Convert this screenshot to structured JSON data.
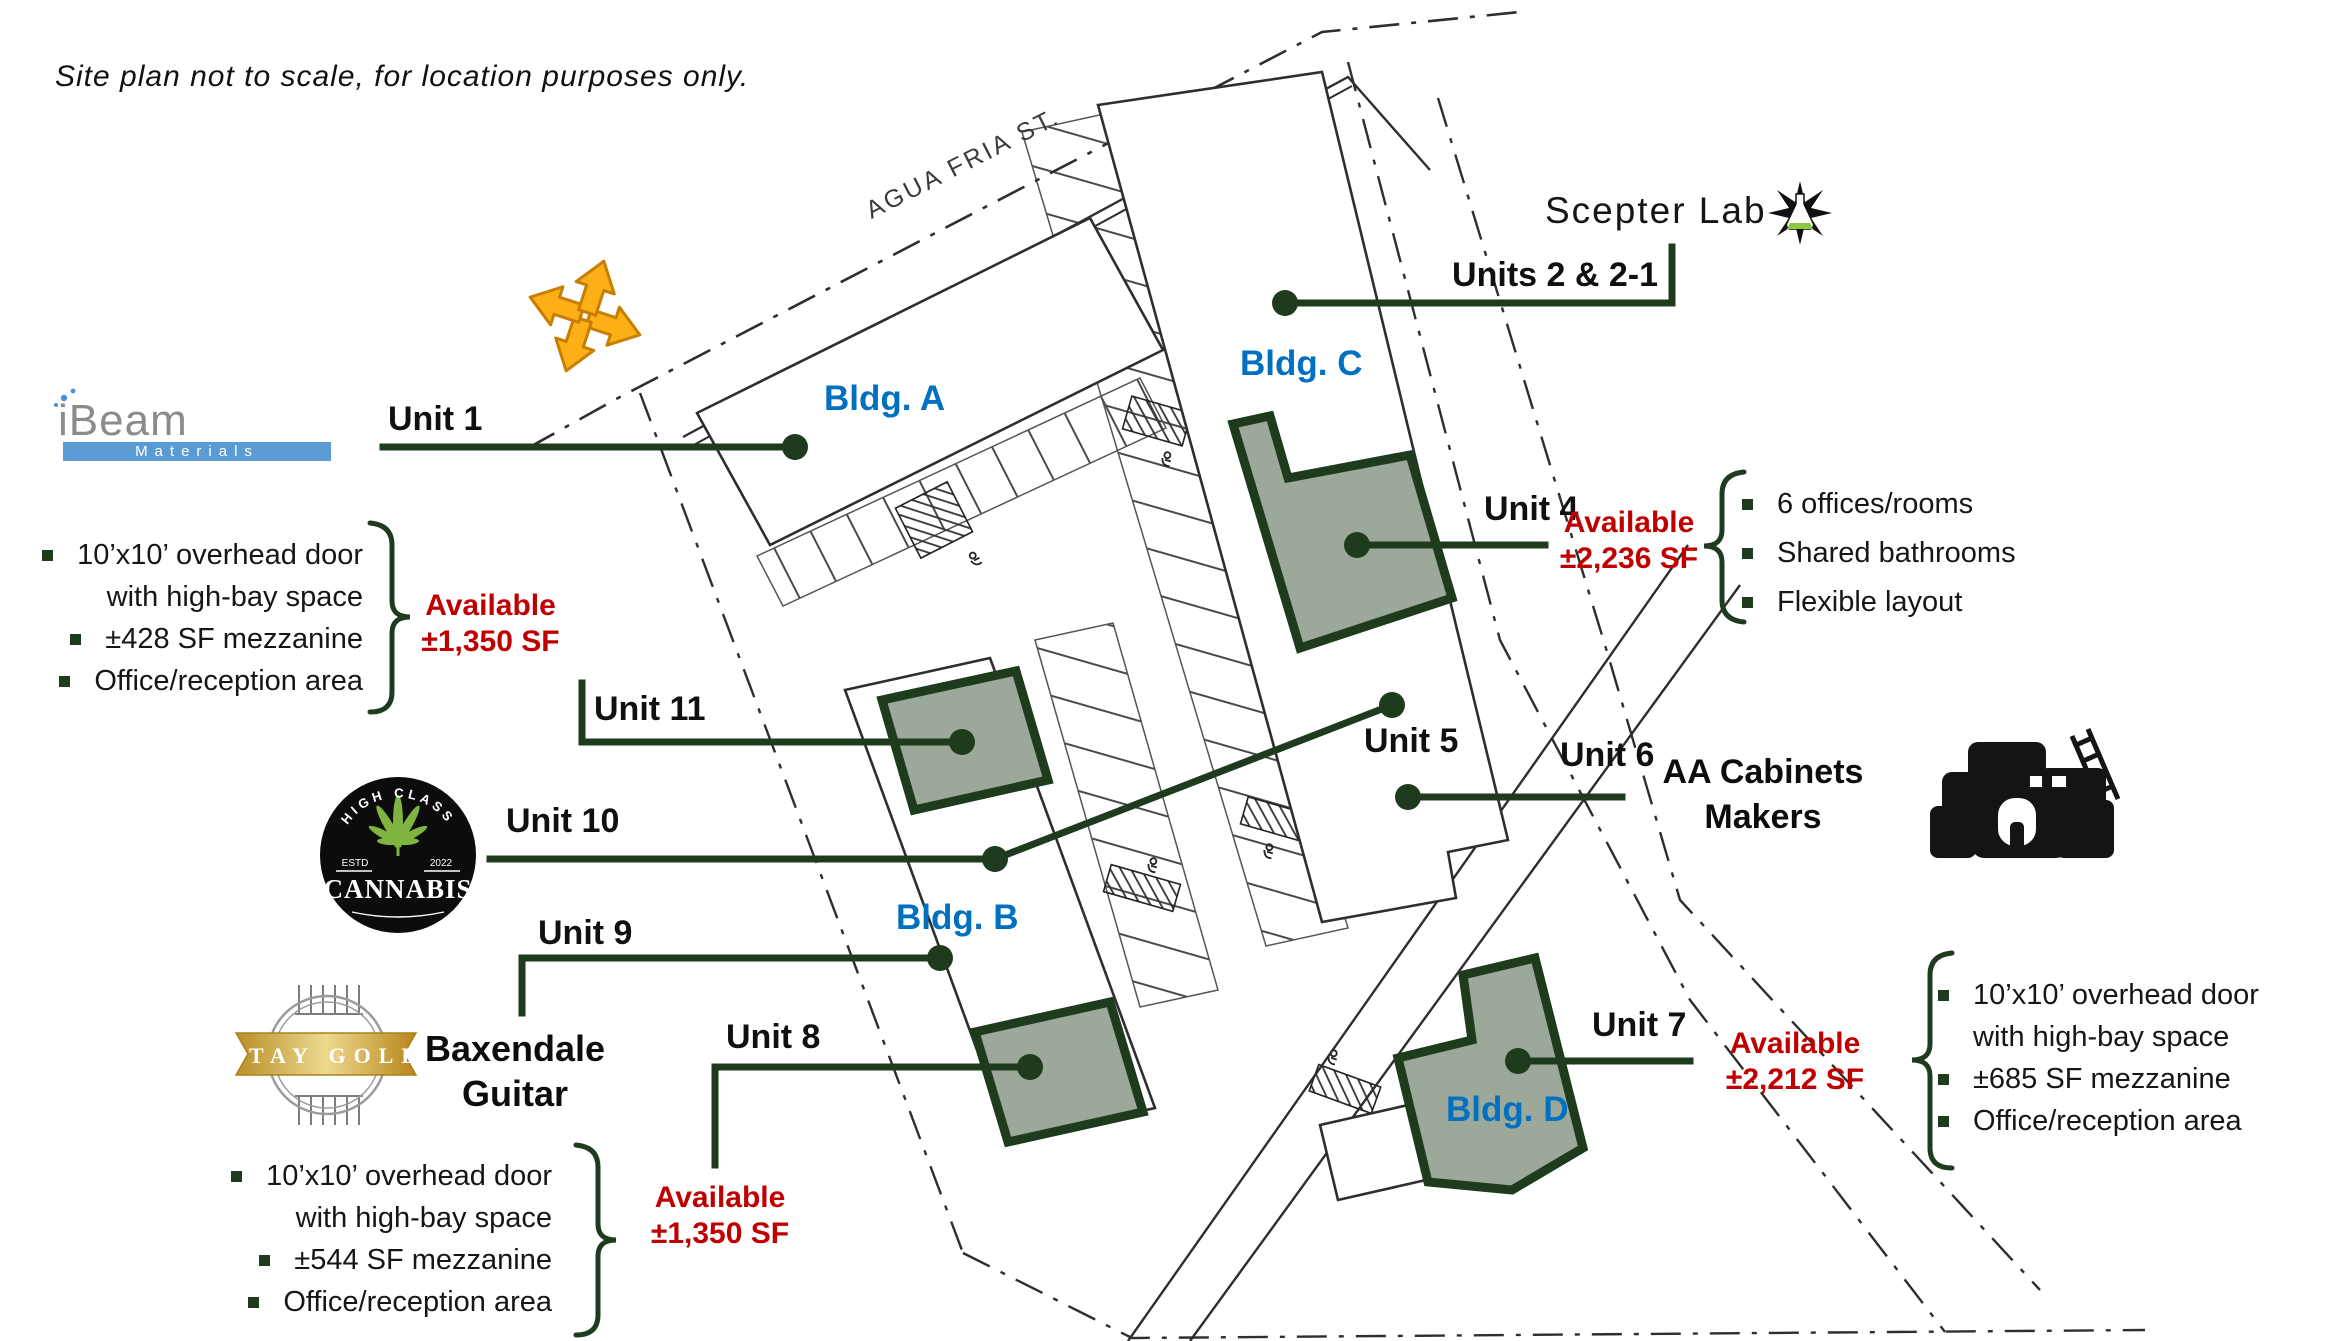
{
  "disclaimer": "Site plan not to scale, for location purposes only.",
  "street_label": "AGUA FRIA ST.",
  "building_labels": {
    "a": "Bldg. A",
    "b": "Bldg. B",
    "c": "Bldg. C",
    "d": "Bldg. D"
  },
  "unit_labels": {
    "u1": "Unit 1",
    "u2": "Units 2 & 2-1",
    "u4": "Unit 4",
    "u5": "Unit 5",
    "u6": "Unit 6",
    "u7": "Unit 7",
    "u8": "Unit 8",
    "u9": "Unit 9",
    "u10": "Unit 10",
    "u11": "Unit 11"
  },
  "availability": {
    "unit11": {
      "label": "Available",
      "size": "±1,350 SF"
    },
    "unit4": {
      "label": "Available",
      "size": "±2,236 SF"
    },
    "unit8": {
      "label": "Available",
      "size": "±1,350 SF"
    },
    "unit7": {
      "label": "Available",
      "size": "±2,212 SF"
    }
  },
  "callouts": {
    "unit11": {
      "items": [
        "10’x10’ overhead door",
        "with high-bay space",
        "±428 SF mezzanine",
        "Office/reception area"
      ]
    },
    "unit4": {
      "items": [
        "6 offices/rooms",
        "Shared bathrooms",
        "Flexible layout"
      ]
    },
    "unit8": {
      "items": [
        "10’x10’ overhead door",
        "with high-bay space",
        "±544 SF mezzanine",
        "Office/reception area"
      ]
    },
    "unit7": {
      "items": [
        "10’x10’ overhead door",
        "with high-bay space",
        "±685 SF mezzanine",
        "Office/reception area"
      ]
    }
  },
  "tenants": {
    "ibeam": {
      "name": "iBeam",
      "sub": "Materials"
    },
    "scepter": {
      "name": "Scepter Lab"
    },
    "cannabis": {
      "arc_top": "HIGH CLASS",
      "estd": "ESTD",
      "year": "2022",
      "name": "CANNABIS"
    },
    "stay_gold": {
      "ribbon": "STAY GOLD"
    },
    "baxendale": {
      "line1": "Baxendale",
      "line2": "Guitar"
    },
    "aa_cabinets": {
      "line1": "AA Cabinets",
      "line2": "Makers"
    }
  },
  "colors": {
    "accent_green": "#1E3B1E",
    "available_red": "#C00000",
    "bldg_blue": "#0070C0",
    "sage": "#9CA99A",
    "gold": "#C9A233",
    "compass_orange": "#FCAF17",
    "ibeam_blue": "#5B9BD5"
  }
}
